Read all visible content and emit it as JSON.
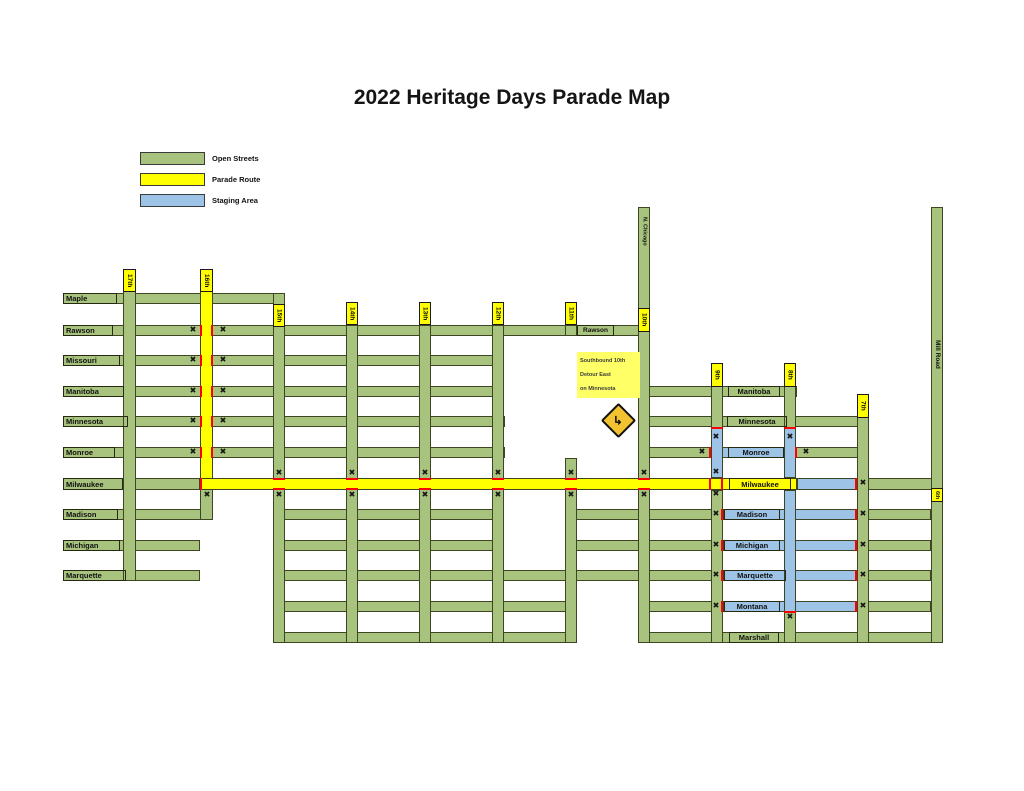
{
  "title": "2022 Heritage Days Parade Map",
  "colors": {
    "open": "#a8c37e",
    "parade": "#ffff00",
    "staging": "#9dc3e6",
    "border": "#3d4522",
    "red": "#ff0000",
    "tag_bg": "#ffff00",
    "note_bg": "#ffff66",
    "sign_bg": "#f2c230",
    "ink": "#111111"
  },
  "legend": {
    "items": [
      {
        "label": "Open Streets",
        "type": "open",
        "y": 152
      },
      {
        "label": "Parade Route",
        "type": "parade",
        "y": 173
      },
      {
        "label": "Staging Area",
        "type": "staging",
        "y": 194
      }
    ],
    "swatch_x": 140,
    "label_x": 212
  },
  "map": {
    "streets": [
      {
        "n": "maple",
        "t": "open",
        "x": 63,
        "y": 293,
        "w": 222,
        "h": 11
      },
      {
        "n": "rawson",
        "t": "open",
        "x": 63,
        "y": 325,
        "w": 587,
        "h": 11
      },
      {
        "n": "missouri",
        "t": "open",
        "x": 63,
        "y": 355,
        "w": 430,
        "h": 11
      },
      {
        "n": "manitoba-west",
        "t": "open",
        "x": 63,
        "y": 386,
        "w": 430,
        "h": 11
      },
      {
        "n": "manitoba-east",
        "t": "open",
        "x": 638,
        "y": 386,
        "w": 159,
        "h": 11
      },
      {
        "n": "minnesota-west",
        "t": "open",
        "x": 63,
        "y": 416,
        "w": 442,
        "h": 11
      },
      {
        "n": "minnesota-east",
        "t": "open",
        "x": 638,
        "y": 416,
        "w": 230,
        "h": 11
      },
      {
        "n": "monroe-west",
        "t": "open",
        "x": 63,
        "y": 447,
        "w": 442,
        "h": 11
      },
      {
        "n": "monroe-east",
        "t": "open",
        "x": 638,
        "y": 447,
        "w": 230,
        "h": 11
      },
      {
        "n": "milwaukee-west",
        "t": "open",
        "x": 63,
        "y": 478,
        "w": 137,
        "h": 12
      },
      {
        "n": "milwaukee-east",
        "t": "open",
        "x": 857,
        "y": 478,
        "w": 86,
        "h": 12
      },
      {
        "n": "madison-west",
        "t": "open",
        "x": 63,
        "y": 509,
        "w": 150,
        "h": 11
      },
      {
        "n": "madison-mid",
        "t": "open",
        "x": 273,
        "y": 509,
        "w": 231,
        "h": 11
      },
      {
        "n": "madison-east",
        "t": "open",
        "x": 565,
        "y": 509,
        "w": 366,
        "h": 11
      },
      {
        "n": "michigan-west",
        "t": "open",
        "x": 63,
        "y": 540,
        "w": 137,
        "h": 11
      },
      {
        "n": "michigan-mid",
        "t": "open",
        "x": 273,
        "y": 540,
        "w": 231,
        "h": 11
      },
      {
        "n": "michigan-east",
        "t": "open",
        "x": 565,
        "y": 540,
        "w": 366,
        "h": 11
      },
      {
        "n": "marquette-west",
        "t": "open",
        "x": 63,
        "y": 570,
        "w": 137,
        "h": 11
      },
      {
        "n": "marquette-mid",
        "t": "open",
        "x": 273,
        "y": 570,
        "w": 658,
        "h": 11
      },
      {
        "n": "montana-mid",
        "t": "open",
        "x": 273,
        "y": 601,
        "w": 304,
        "h": 11
      },
      {
        "n": "montana-east",
        "t": "open",
        "x": 638,
        "y": 601,
        "w": 293,
        "h": 11
      },
      {
        "n": "marshall-mid",
        "t": "open",
        "x": 273,
        "y": 632,
        "w": 304,
        "h": 11
      },
      {
        "n": "marshall-east",
        "t": "open",
        "x": 638,
        "y": 632,
        "w": 305,
        "h": 11
      },
      {
        "n": "17th",
        "t": "open",
        "x": 123,
        "y": 291,
        "w": 13,
        "h": 290
      },
      {
        "n": "16th-south",
        "t": "open",
        "x": 200,
        "y": 489,
        "w": 13,
        "h": 31
      },
      {
        "n": "15th",
        "t": "open",
        "x": 273,
        "y": 293,
        "w": 12,
        "h": 350
      },
      {
        "n": "14th",
        "t": "open",
        "x": 346,
        "y": 325,
        "w": 12,
        "h": 318
      },
      {
        "n": "13th",
        "t": "open",
        "x": 419,
        "y": 325,
        "w": 12,
        "h": 318
      },
      {
        "n": "12th",
        "t": "open",
        "x": 492,
        "y": 325,
        "w": 12,
        "h": 318
      },
      {
        "n": "11th-rawson",
        "t": "open",
        "x": 565,
        "y": 325,
        "w": 12,
        "h": 11
      },
      {
        "n": "11th-south",
        "t": "open",
        "x": 565,
        "y": 458,
        "w": 12,
        "h": 185
      },
      {
        "n": "10th-n-chicago",
        "t": "open",
        "x": 638,
        "y": 207,
        "w": 12,
        "h": 436
      },
      {
        "n": "9th-north",
        "t": "open",
        "x": 711,
        "y": 386,
        "w": 12,
        "h": 42
      },
      {
        "n": "9th-south",
        "t": "open",
        "x": 711,
        "y": 490,
        "w": 12,
        "h": 153
      },
      {
        "n": "8th-north",
        "t": "open",
        "x": 784,
        "y": 386,
        "w": 12,
        "h": 42
      },
      {
        "n": "8th-south",
        "t": "open",
        "x": 784,
        "y": 612,
        "w": 12,
        "h": 31
      },
      {
        "n": "7th",
        "t": "open",
        "x": 857,
        "y": 416,
        "w": 12,
        "h": 227
      },
      {
        "n": "mill-road-6th",
        "t": "open",
        "x": 931,
        "y": 207,
        "w": 12,
        "h": 436
      },
      {
        "n": "monroe-staging",
        "t": "staging",
        "x": 709,
        "y": 447,
        "w": 88,
        "h": 11
      },
      {
        "n": "milwaukee-staging",
        "t": "staging",
        "x": 797,
        "y": 478,
        "w": 60,
        "h": 12
      },
      {
        "n": "madison-staging",
        "t": "staging",
        "x": 723,
        "y": 509,
        "w": 134,
        "h": 11
      },
      {
        "n": "michigan-staging",
        "t": "staging",
        "x": 723,
        "y": 540,
        "w": 134,
        "h": 11
      },
      {
        "n": "marquette-staging",
        "t": "staging",
        "x": 723,
        "y": 570,
        "w": 134,
        "h": 11
      },
      {
        "n": "montana-staging",
        "t": "staging",
        "x": 723,
        "y": 601,
        "w": 134,
        "h": 11
      },
      {
        "n": "9th-staging",
        "t": "staging",
        "x": 711,
        "y": 428,
        "w": 12,
        "h": 50
      },
      {
        "n": "8th-staging-upper",
        "t": "staging",
        "x": 784,
        "y": 428,
        "w": 12,
        "h": 50
      },
      {
        "n": "8th-staging-lower",
        "t": "staging",
        "x": 784,
        "y": 490,
        "w": 12,
        "h": 122
      },
      {
        "n": "16th-parade-route",
        "t": "parade",
        "x": 200,
        "y": 291,
        "w": 13,
        "h": 199
      },
      {
        "n": "milwaukee-parade-route",
        "t": "parade",
        "x": 200,
        "y": 478,
        "w": 597,
        "h": 12
      }
    ],
    "red_marks": [
      [
        200,
        325,
        2,
        11
      ],
      [
        211,
        325,
        2,
        11
      ],
      [
        200,
        355,
        2,
        11
      ],
      [
        211,
        355,
        2,
        11
      ],
      [
        200,
        386,
        2,
        11
      ],
      [
        211,
        386,
        2,
        11
      ],
      [
        200,
        416,
        2,
        11
      ],
      [
        211,
        416,
        2,
        11
      ],
      [
        200,
        447,
        2,
        11
      ],
      [
        211,
        447,
        2,
        11
      ],
      [
        200,
        478,
        2,
        12
      ],
      [
        273,
        478,
        12,
        2
      ],
      [
        273,
        488,
        12,
        2
      ],
      [
        346,
        478,
        12,
        2
      ],
      [
        346,
        488,
        12,
        2
      ],
      [
        419,
        478,
        12,
        2
      ],
      [
        419,
        488,
        12,
        2
      ],
      [
        492,
        478,
        12,
        2
      ],
      [
        492,
        488,
        12,
        2
      ],
      [
        565,
        478,
        12,
        2
      ],
      [
        565,
        488,
        12,
        2
      ],
      [
        638,
        478,
        12,
        2
      ],
      [
        638,
        488,
        12,
        2
      ],
      [
        709,
        478,
        2,
        12
      ],
      [
        721,
        478,
        2,
        12
      ],
      [
        711,
        427,
        12,
        2
      ],
      [
        784,
        427,
        12,
        2
      ],
      [
        709,
        447,
        2,
        11
      ],
      [
        795,
        447,
        2,
        11
      ],
      [
        721,
        509,
        2,
        11
      ],
      [
        721,
        540,
        2,
        11
      ],
      [
        721,
        570,
        2,
        11
      ],
      [
        721,
        601,
        2,
        11
      ],
      [
        855,
        509,
        2,
        11
      ],
      [
        855,
        540,
        2,
        11
      ],
      [
        855,
        570,
        2,
        11
      ],
      [
        855,
        601,
        2,
        11
      ],
      [
        855,
        478,
        2,
        12
      ],
      [
        784,
        611,
        12,
        2
      ]
    ],
    "closures": [
      [
        193,
        330
      ],
      [
        223,
        330
      ],
      [
        193,
        360
      ],
      [
        223,
        360
      ],
      [
        193,
        391
      ],
      [
        223,
        391
      ],
      [
        193,
        421
      ],
      [
        223,
        421
      ],
      [
        193,
        452
      ],
      [
        223,
        452
      ],
      [
        207,
        495
      ],
      [
        279,
        473
      ],
      [
        279,
        495
      ],
      [
        352,
        473
      ],
      [
        352,
        495
      ],
      [
        425,
        473
      ],
      [
        425,
        495
      ],
      [
        498,
        473
      ],
      [
        498,
        495
      ],
      [
        571,
        473
      ],
      [
        571,
        495
      ],
      [
        644,
        473
      ],
      [
        644,
        495
      ],
      [
        716,
        437
      ],
      [
        790,
        437
      ],
      [
        702,
        452
      ],
      [
        806,
        452
      ],
      [
        716,
        472
      ],
      [
        716,
        494
      ],
      [
        863,
        483
      ],
      [
        716,
        514
      ],
      [
        863,
        514
      ],
      [
        716,
        545
      ],
      [
        863,
        545
      ],
      [
        716,
        575
      ],
      [
        863,
        575
      ],
      [
        716,
        606
      ],
      [
        863,
        606
      ],
      [
        790,
        617
      ]
    ],
    "closure_glyph": "✖",
    "labels": [
      {
        "text": "Maple",
        "x": 63,
        "y": 293,
        "w": 54,
        "h": 11,
        "kind": "cell",
        "align": "left"
      },
      {
        "text": "Rawson",
        "x": 63,
        "y": 325,
        "w": 50,
        "h": 11,
        "kind": "cell",
        "align": "left"
      },
      {
        "text": "Missouri",
        "x": 63,
        "y": 355,
        "w": 57,
        "h": 11,
        "kind": "cell",
        "align": "left"
      },
      {
        "text": "Manitoba",
        "x": 63,
        "y": 386,
        "w": 61,
        "h": 11,
        "kind": "cell",
        "align": "left"
      },
      {
        "text": "Minnesota",
        "x": 63,
        "y": 416,
        "w": 65,
        "h": 11,
        "kind": "cell",
        "align": "left"
      },
      {
        "text": "Monroe",
        "x": 63,
        "y": 447,
        "w": 52,
        "h": 11,
        "kind": "cell",
        "align": "left"
      },
      {
        "text": "Milwaukee",
        "x": 63,
        "y": 478,
        "w": 60,
        "h": 12,
        "kind": "cell",
        "align": "left"
      },
      {
        "text": "Madison",
        "x": 63,
        "y": 509,
        "w": 55,
        "h": 11,
        "kind": "cell",
        "align": "left"
      },
      {
        "text": "Michigan",
        "x": 63,
        "y": 540,
        "w": 57,
        "h": 11,
        "kind": "cell",
        "align": "left"
      },
      {
        "text": "Marquette",
        "x": 63,
        "y": 570,
        "w": 63,
        "h": 11,
        "kind": "cell",
        "align": "left"
      },
      {
        "text": "Rawson",
        "x": 577,
        "y": 325,
        "w": 37,
        "h": 11,
        "kind": "cell",
        "align": "center",
        "fs": 6.5
      },
      {
        "text": "Manitoba",
        "x": 728,
        "y": 386,
        "w": 52,
        "h": 11,
        "kind": "cell",
        "align": "center"
      },
      {
        "text": "Minnesota",
        "x": 727,
        "y": 416,
        "w": 60,
        "h": 11,
        "kind": "cell",
        "align": "center"
      },
      {
        "text": "Monroe",
        "x": 728,
        "y": 447,
        "w": 56,
        "h": 11,
        "kind": "cell",
        "align": "center"
      },
      {
        "text": "Milwaukee",
        "x": 729,
        "y": 478,
        "w": 62,
        "h": 12,
        "kind": "cell",
        "align": "center"
      },
      {
        "text": "Madison",
        "x": 724,
        "y": 509,
        "w": 56,
        "h": 11,
        "kind": "cell",
        "align": "center"
      },
      {
        "text": "Michigan",
        "x": 724,
        "y": 540,
        "w": 56,
        "h": 11,
        "kind": "cell",
        "align": "center"
      },
      {
        "text": "Marquette",
        "x": 724,
        "y": 570,
        "w": 62,
        "h": 11,
        "kind": "cell",
        "align": "center"
      },
      {
        "text": "Montana",
        "x": 724,
        "y": 601,
        "w": 56,
        "h": 11,
        "kind": "cell",
        "align": "center"
      },
      {
        "text": "Marshall",
        "x": 729,
        "y": 632,
        "w": 50,
        "h": 11,
        "kind": "cell",
        "align": "center"
      },
      {
        "text": "17th",
        "x": 123,
        "y": 269,
        "w": 13,
        "h": 23,
        "kind": "tag"
      },
      {
        "text": "16th",
        "x": 200,
        "y": 269,
        "w": 13,
        "h": 23,
        "kind": "tag"
      },
      {
        "text": "15th",
        "x": 273,
        "y": 304,
        "w": 12,
        "h": 23,
        "kind": "tag"
      },
      {
        "text": "14th",
        "x": 346,
        "y": 302,
        "w": 12,
        "h": 23,
        "kind": "tag"
      },
      {
        "text": "13th",
        "x": 419,
        "y": 302,
        "w": 12,
        "h": 23,
        "kind": "tag"
      },
      {
        "text": "12th",
        "x": 492,
        "y": 302,
        "w": 12,
        "h": 23,
        "kind": "tag"
      },
      {
        "text": "11th",
        "x": 565,
        "y": 302,
        "w": 12,
        "h": 23,
        "kind": "tag"
      },
      {
        "text": "10th",
        "x": 638,
        "y": 308,
        "w": 12,
        "h": 24,
        "kind": "tag"
      },
      {
        "text": "9th",
        "x": 711,
        "y": 363,
        "w": 12,
        "h": 24,
        "kind": "tag"
      },
      {
        "text": "8th",
        "x": 784,
        "y": 363,
        "w": 12,
        "h": 24,
        "kind": "tag"
      },
      {
        "text": "7th",
        "x": 857,
        "y": 394,
        "w": 12,
        "h": 24,
        "kind": "tag"
      },
      {
        "text": "6th",
        "x": 931,
        "y": 488,
        "w": 12,
        "h": 14,
        "kind": "tag",
        "fs": 5.5
      },
      {
        "text": "N. Chicago",
        "x": 639,
        "y": 208,
        "w": 11,
        "h": 46,
        "kind": "vtext",
        "fs": 5.5
      },
      {
        "text": "Mill Road",
        "x": 932,
        "y": 318,
        "w": 11,
        "h": 72,
        "kind": "vtext",
        "fs": 6.5
      }
    ],
    "detour_note": {
      "x": 577,
      "y": 352,
      "w": 60,
      "h": 44,
      "lines": [
        "Southbound 10th",
        "Detour East",
        "on Minnesota"
      ]
    },
    "detour_sign": {
      "x": 606,
      "y": 408,
      "size": 21,
      "arrow": "↳"
    }
  }
}
